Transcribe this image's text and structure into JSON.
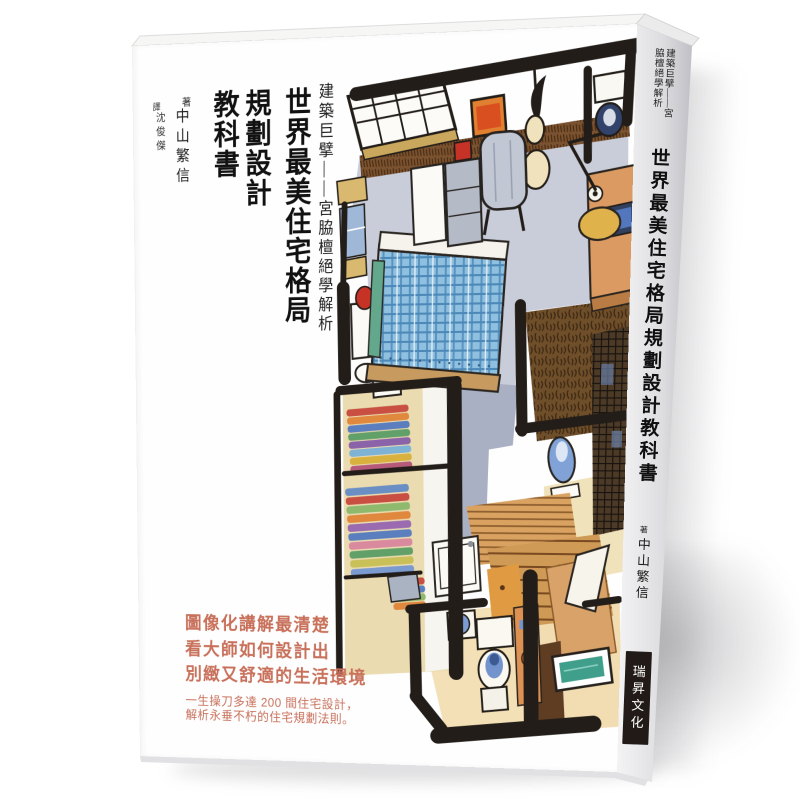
{
  "page": {
    "background": "#ffffff"
  },
  "book": {
    "front_cover": {
      "series_subtitle": "建築巨擘——宮脇檀絕學解析",
      "title_lines": [
        "世界最美住宅格局",
        "規劃設計",
        "教科書"
      ],
      "author_label": "著",
      "author_name": "中山繁信",
      "translator_label": "譯",
      "translator_name": "沈俊傑",
      "headline_lines": [
        "圖像化講解最清楚",
        "看大師如何設計出",
        "別緻又舒適的生活環境"
      ],
      "subtext_lines": [
        "一生操刀多達 200 間住宅設計，",
        "解析永垂不朽的住宅規劃法則。"
      ],
      "accent_color": "#c8705a"
    },
    "spine": {
      "series_subtitle": "建築巨擘——宮脇檀絕學解析",
      "title": "世界最美住宅格局規劃設計教科書",
      "author_label": "著",
      "author_name": "中山繁信",
      "publisher": "瑞昇文化",
      "publisher_box_color": "#211a16",
      "publisher_text_color": "#ffffff"
    },
    "illustration": {
      "kind": "hand-drawn axonometric apartment floor-plan sketch",
      "rooms": [
        "bedroom",
        "study corner",
        "walk-in closet",
        "bathroom",
        "stairs",
        "laundry"
      ],
      "palette": {
        "ink": "#221d18",
        "floor_gray_blue": "#c9cdd9",
        "floor_beige": "#f2e0b4",
        "wood": "#d49a58",
        "wood_dark": "#6f4e2a",
        "bed_plaid": "#8fc0e0",
        "fixture_blue": "#7b9cd2",
        "bath_teal": "#3f9f8a",
        "accent_orange": "#dd9254",
        "accent_red": "#c63326",
        "lamp_cream": "#f0e2bc",
        "chair_yellow": "#dfb24c"
      }
    }
  }
}
